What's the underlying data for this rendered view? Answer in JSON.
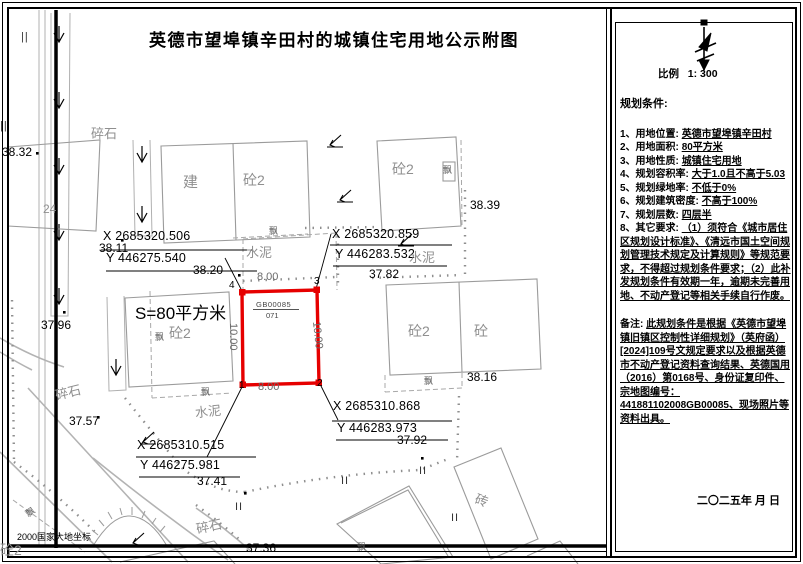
{
  "sheet": {
    "title": "英德市望埠镇辛田村的城镇住宅用地公示附图",
    "scale_label": "比例",
    "scale_value": "1: 300",
    "geodetic_note": "2000国家大地坐标"
  },
  "parcel": {
    "area_label": "S=80平方米",
    "code_numerator": "GB00085",
    "code_denominator": "071",
    "width_m": "8.00",
    "depth_m": "10.00",
    "corners": {
      "p1": {
        "n": "1",
        "x": "X 2685310.515",
        "y": "Y 446275.981"
      },
      "p2": {
        "n": "2",
        "x": "X 2685310.868",
        "y": "Y 446283.973"
      },
      "p3": {
        "n": "3",
        "x": "X 2685320.859",
        "y": "Y 446283.532"
      },
      "p4": {
        "n": "4",
        "x": "X 2685320.506",
        "y": "Y 446275.540"
      }
    }
  },
  "map": {
    "elevations": {
      "e38_32": "38.32",
      "e38_39": "38.39",
      "e38_20": "38.20",
      "e38_11": "38.11",
      "e38_16": "38.16",
      "e37_82": "37.82",
      "e37_96": "37.96",
      "e37_57": "37.57",
      "e37_41": "37.41",
      "e37_92": "37.92",
      "e37_36": "37.36"
    },
    "features": {
      "suishi": "碎石",
      "shuini": "水泥",
      "jian": "建",
      "tong2": "砼2",
      "tong": "砼",
      "zhuan": "砖",
      "piao": "飘",
      "n24": "24",
      "grass": "II",
      "grass_v": "||"
    }
  },
  "panel": {
    "heading": "规划条件:",
    "items": [
      {
        "label": "1、用地位置:",
        "value": "英德市望埠镇辛田村"
      },
      {
        "label": "2、用地面积:",
        "value": "80平方米"
      },
      {
        "label": "3、用地性质:",
        "value": "城镇住宅用地"
      },
      {
        "label": "4、规划容积率:",
        "value": "大于1.0且不高于5.03"
      },
      {
        "label": "5、规划绿地率:",
        "value": "不低于0%"
      },
      {
        "label": "6、规划建筑密度:",
        "value": "不高于100%"
      },
      {
        "label": "7、规划层数:",
        "value": "四层半"
      },
      {
        "label": "8、其它要求:",
        "value": "（1）须符合《城市居住区规划设计标准》、《清远市国土空间规划管理技术规定及计算规则》等规范要求，不得超过规划条件要求；（2）此补发规划条件有效期一年，逾期未完善用地、不动产登记等相关手续自行作废。"
      }
    ],
    "note_label": "备注:",
    "note_value": "此规划条件是根据《英德市望埠镇旧镇区控制性详细规划》（英府函）[2024]109号文规定要求以及根据英德市不动产登记资料查询结果、英德国用（2016）第0168号、身份证复印件、宗地图编号：441881102008GB00085、现场照片等资料出具。",
    "date": "二〇二五年  月  日"
  }
}
